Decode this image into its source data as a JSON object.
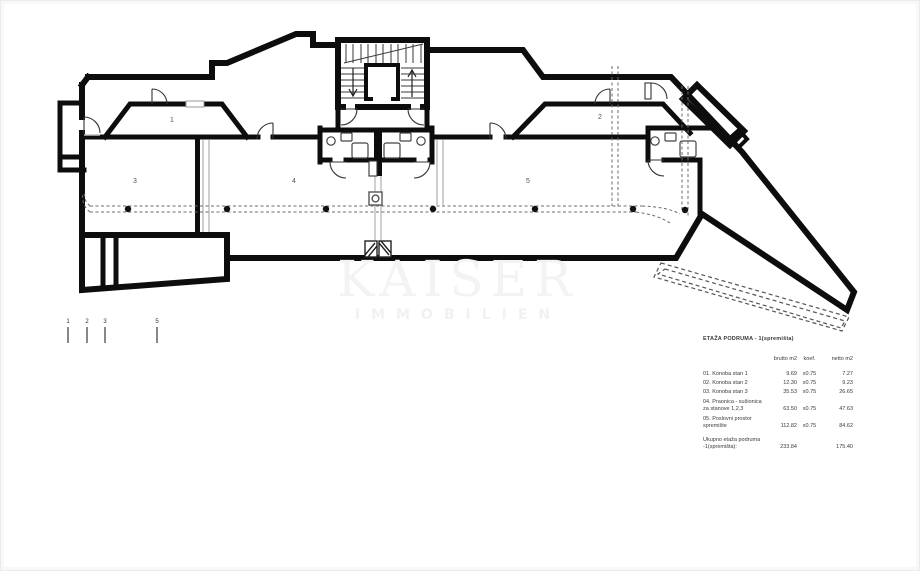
{
  "watermark": {
    "line1": "KAISER",
    "line2": "IMMOBILIEN"
  },
  "plan": {
    "room_labels": {
      "r1": "1",
      "r2": "2",
      "r3": "3",
      "r4": "4",
      "r5": "5"
    },
    "section_marks": [
      "1",
      "2",
      "3",
      "5"
    ]
  },
  "table": {
    "title": "ETAŽA PODRUMA - 1(spremišta)",
    "headers": {
      "brutto": "brutto m2",
      "koef": "koef.",
      "netto": "netto m2"
    },
    "rows": [
      {
        "no": "01.",
        "name": "Konoba stan 1",
        "name2": "",
        "brutto": "9.69",
        "koef": "x0.75",
        "netto": "7.27"
      },
      {
        "no": "02.",
        "name": "Konoba stan 2",
        "name2": "",
        "brutto": "12.30",
        "koef": "x0.75",
        "netto": "9.23"
      },
      {
        "no": "03.",
        "name": "Konoba stan 3",
        "name2": "",
        "brutto": "35.53",
        "koef": "x0.75",
        "netto": "26.65"
      },
      {
        "no": "04.",
        "name": "Praonica - sušionica",
        "name2": "za stanove 1,2,3",
        "brutto": "63.50",
        "koef": "x0.75",
        "netto": "47.63"
      },
      {
        "no": "05.",
        "name": "Poslovni prostor",
        "name2": "spremište",
        "brutto": "112.82",
        "koef": "x0.75",
        "netto": "84.62"
      }
    ],
    "total": {
      "label1": "Ukupno etaža podruma",
      "label2": "-1(spremišta):",
      "brutto": "233.84",
      "netto": "175.40"
    }
  }
}
